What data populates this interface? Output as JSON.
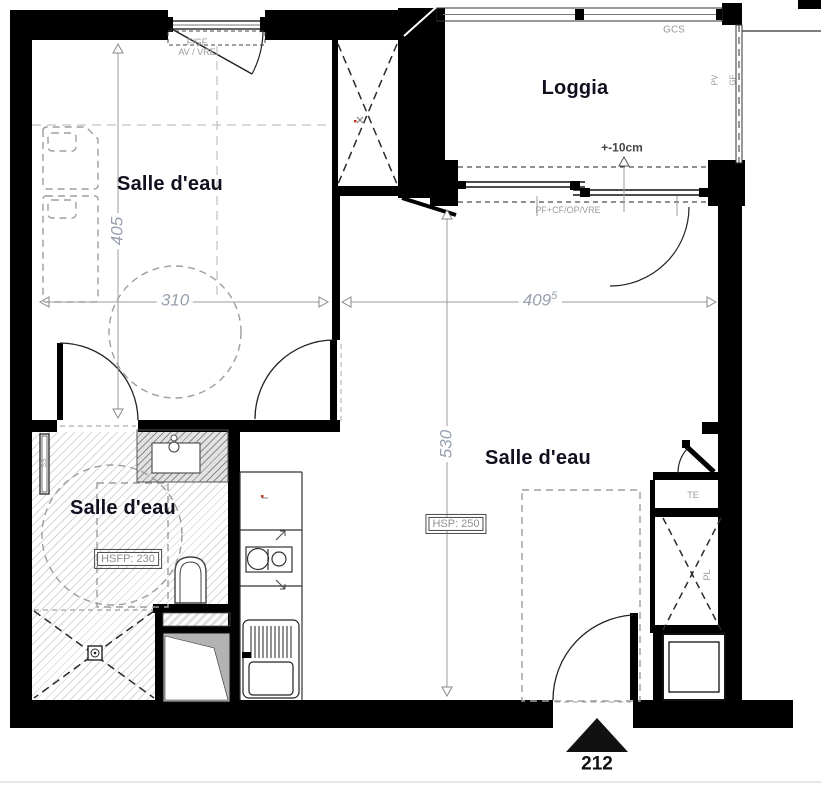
{
  "plan": {
    "bedroom": {
      "label": "Salle d'eau",
      "dim_width": "310",
      "dim_height": "405",
      "window_label1": "F/GF",
      "window_label2": "AV / VRE"
    },
    "living": {
      "label": "Salle d'eau",
      "dim_width": "409",
      "dim_width_sup": "5",
      "dim_height": "530",
      "ceiling_height": "HSP: 250"
    },
    "bathroom": {
      "label": "Salle d'eau",
      "ceiling_height": "HSFP: 230",
      "towel_rail": "SS"
    },
    "loggia": {
      "label": "Loggia",
      "rail_label": "GCS",
      "level_note": "+-10cm",
      "bay_label": "PF+CF/OP/VRE",
      "pv": "PV",
      "gf": "GF"
    },
    "closets": {
      "te": "TE",
      "pl": "PL"
    },
    "entrance": {
      "unit_number": "212"
    }
  }
}
